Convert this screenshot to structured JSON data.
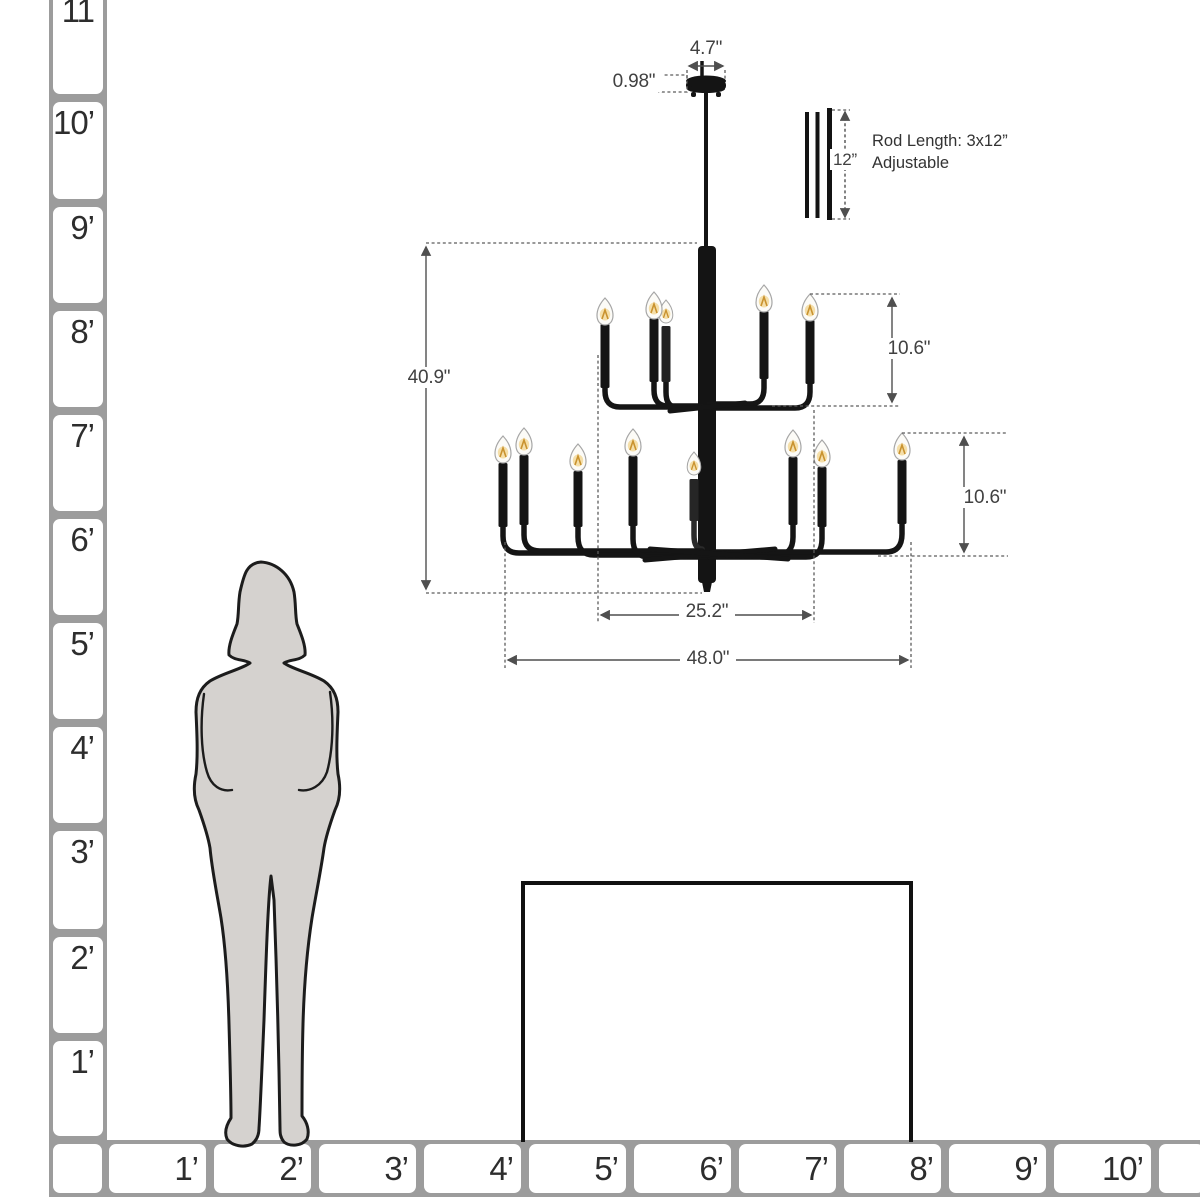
{
  "canopy": {
    "width": "4.7\"",
    "thickness": "0.98\""
  },
  "rod": {
    "length": "12”",
    "note_line1": "Rod Length: 3x12”",
    "note_line2": "Adjustable"
  },
  "chandelier": {
    "overall_height": "40.9\"",
    "top_tier_height": "10.6\"",
    "bottom_tier_height": "10.6\"",
    "top_tier_width": "25.2\"",
    "bottom_tier_width": "48.0\""
  },
  "vruler": {
    "labels": [
      "11",
      "10’",
      "9’",
      "8’",
      "7’",
      "6’",
      "5’",
      "4’",
      "3’",
      "2’",
      "1’"
    ]
  },
  "hruler": {
    "labels": [
      "1’",
      "2’",
      "3’",
      "4’",
      "5’",
      "6’",
      "7’",
      "8’",
      "9’",
      "10’"
    ]
  }
}
